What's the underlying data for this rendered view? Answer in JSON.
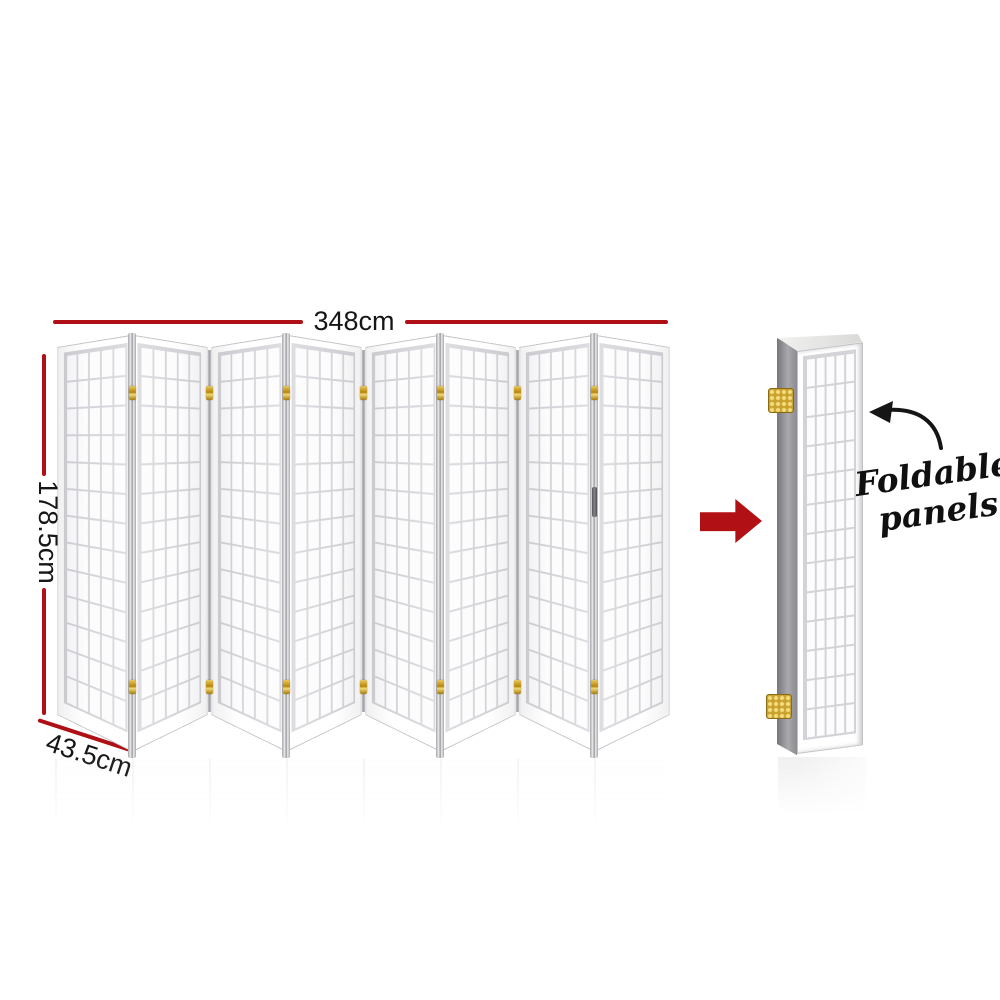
{
  "dimensions": {
    "width": "348cm",
    "height": "178.5cm",
    "depth": "43.5cm"
  },
  "annotation": {
    "line1": "Foldable",
    "line2": "panels"
  },
  "screen": {
    "panel_count": 8,
    "grid_columns_per_panel": 5,
    "grid_rows_per_panel": 13,
    "joint_count": 7,
    "hinges_per_joint": 2
  },
  "icons": {
    "transform_arrow": "right-arrow-icon",
    "callout_arrow": "curved-arrow-icon",
    "hinges": "hinge-icon"
  },
  "colors": {
    "background": "#ffffff",
    "dimension_line_red": "#ae1015",
    "transform_arrow_red": "#b11015",
    "label_text": "#161616",
    "panel_frame": "#ffffff",
    "panel_grid_line": "#d2d2d7",
    "stack_side_gray": "#8c8c90",
    "hinge_gold": "#c9a22e"
  }
}
